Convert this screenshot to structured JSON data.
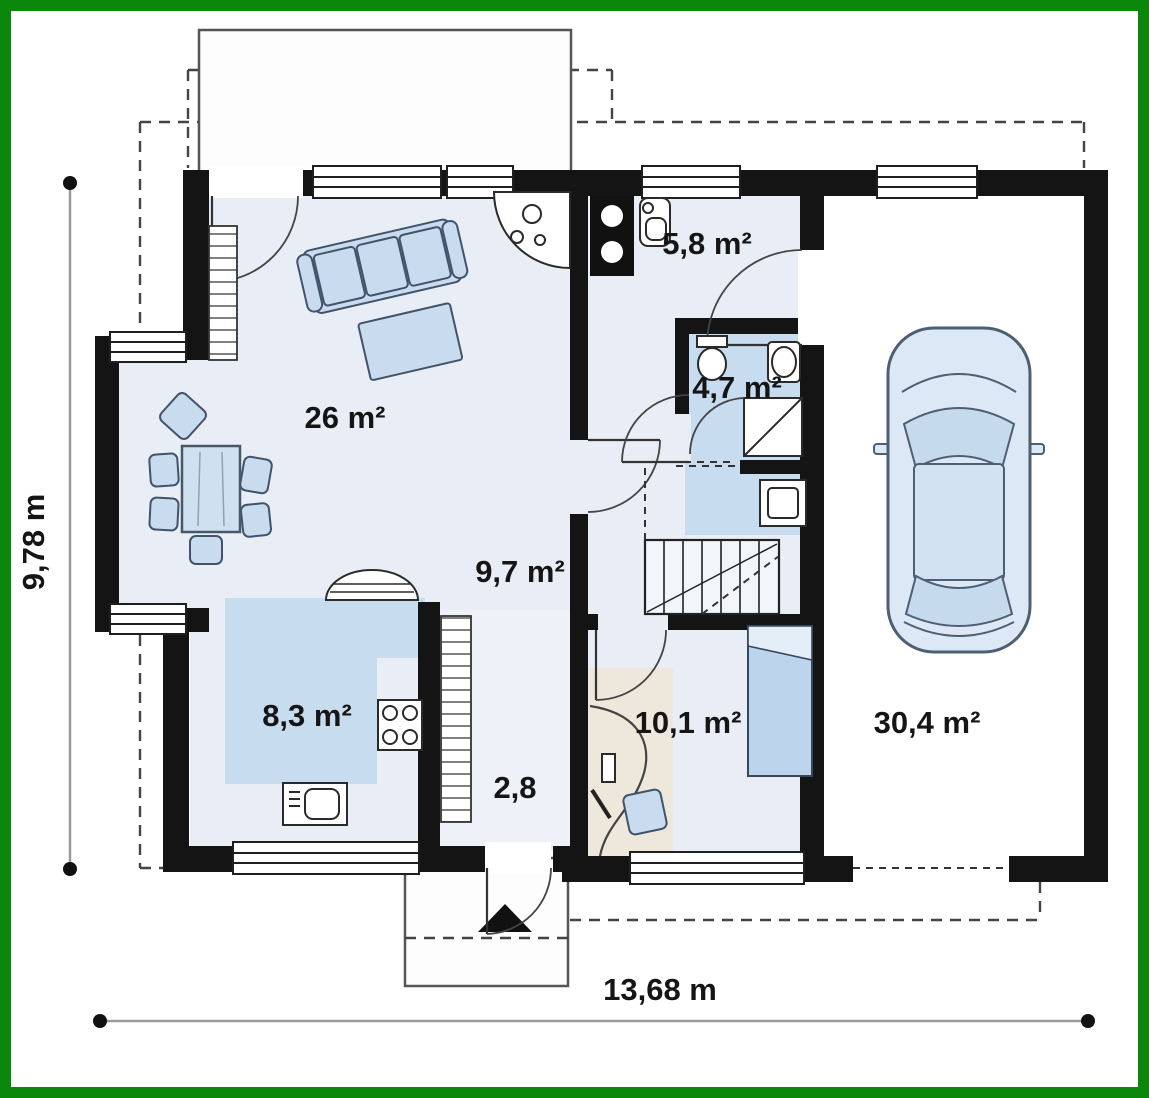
{
  "labels": {
    "living": "26 m²",
    "utility": "5,8 m²",
    "bathroom": "4,7 m²",
    "hall": "9,7 m²",
    "kitchen": "8,3 m²",
    "corridor": "2,8",
    "bedroom": "10,1 m²",
    "garage": "30,4 m²"
  },
  "dimensions": {
    "width": "13,68 m",
    "height": "9,78 m"
  },
  "colors": {
    "frame": "#0b870b",
    "wall": "#141414",
    "floor": "#e8edf6",
    "accent": "#c8dcf0",
    "furniture": "#c9dcef",
    "line": "#444444"
  }
}
